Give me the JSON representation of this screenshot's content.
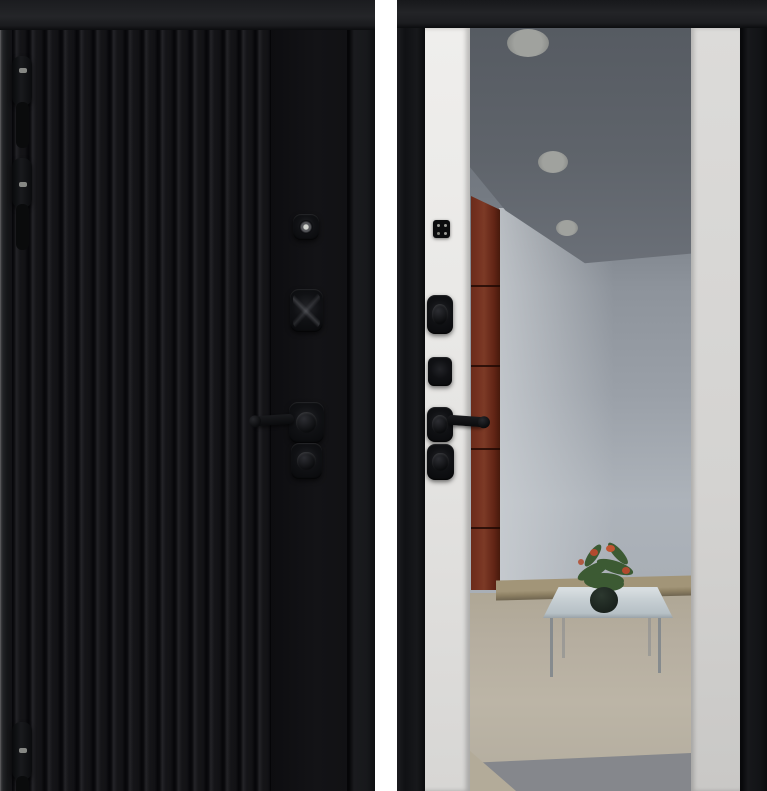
{
  "scene": {
    "type": "product-photo",
    "subject": "Steel entry door shown from both sides",
    "panels": [
      {
        "id": "exterior",
        "description": "Exterior side: matte black door with vertical ribbed cladding, three black hinges, peephole, cylinder cover, lever handle and deadbolt escutcheon"
      },
      {
        "id": "interior",
        "description": "Interior side: black frame with white side trims and a full-height mirror reflecting a hallway with recessed ceiling spotlights, a red cabinet, a glass coffee table and a potted plant"
      }
    ],
    "hardware": {
      "exterior": [
        "door-hinge",
        "peephole",
        "lock-cylinder-cover",
        "lever-handle",
        "deadbolt-escutcheon"
      ],
      "interior": [
        "lock-indicator",
        "lock-cylinder",
        "key-escutcheon",
        "lever-handle",
        "deadbolt"
      ]
    },
    "mirror_reflection": [
      "ceiling-spotlights",
      "red-cabinet",
      "glass-coffee-table",
      "potted-plant",
      "tile-floor"
    ]
  },
  "colors": {
    "page_bg": "#ffffff",
    "door_leaf_black": "#131316",
    "door_frame_dark": "#1d1e21",
    "rib_groove": "#07070a",
    "smooth_panel": "#101013",
    "hardware_black": "#0b0c0e",
    "hardware_highlight": "#9a9b96",
    "trim_white_left": "#e9e8e6",
    "trim_white_right": "#d4d3d1",
    "mirror_ceiling": "#5f646b",
    "mirror_wall": "#9aa0a8",
    "cabinet_red": "#73301f",
    "floor_wood": "#a29578",
    "floor_beige": "#b6aea0",
    "floor_tile": "#85878c",
    "table_glass": "#c7cfd3",
    "plant_green": "#3c5a33",
    "plant_flower": "#b24a2e",
    "pot_dark": "#1a221d",
    "ceiling_light": "#a0a29e"
  }
}
